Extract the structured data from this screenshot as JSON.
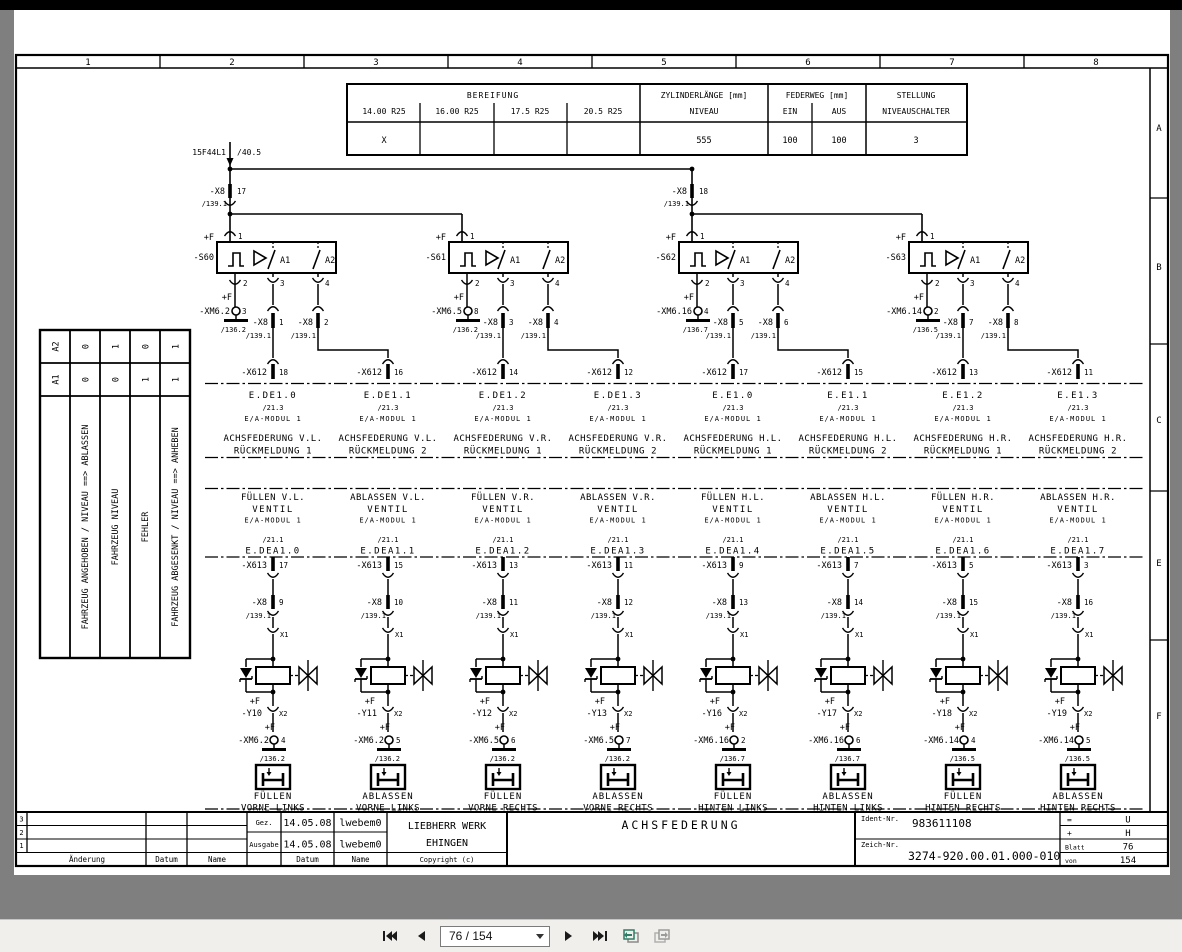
{
  "colors": {
    "paper": "#ffffff",
    "ink": "#000000",
    "viewer_bg": "#7f7f7f",
    "toolbar_bg": "#f1efeb",
    "view_icon_green": "#2e7d68",
    "view_icon_gray": "#9b9b9b"
  },
  "frame": {
    "column_labels": [
      "1",
      "2",
      "3",
      "4",
      "5",
      "6",
      "7",
      "8"
    ],
    "row_labels": [
      "A",
      "B",
      "C",
      "E",
      "F"
    ]
  },
  "spec_table": {
    "bereifung": "BEREIFUNG",
    "tires": [
      "14.00 R25",
      "16.00 R25",
      "17.5 R25",
      "20.5 R25"
    ],
    "tire_values": [
      "X",
      "",
      "",
      ""
    ],
    "zyl_l1": "ZYLINDERLÄNGE [mm]",
    "zyl_l2": "NIVEAU",
    "zyl_value": "555",
    "feder": "FEDERWEG [mm]",
    "feder_cols": [
      "EIN",
      "AUS"
    ],
    "feder_values": [
      "100",
      "100"
    ],
    "stellung_l1": "STELLUNG",
    "stellung_l2": "NIVEAUSCHALTER",
    "stellung_value": "3"
  },
  "state_table": {
    "header_col": [
      "A2",
      "A1"
    ],
    "columns": [
      {
        "a2": "0",
        "a1": "0",
        "label": "FAHRZEUG ANGEHOBEN / NIVEAU ==> ABLASSEN"
      },
      {
        "a2": "1",
        "a1": "0",
        "label": "FAHRZEUG NIVEAU"
      },
      {
        "a2": "0",
        "a1": "1",
        "label": "FEHLER"
      },
      {
        "a2": "1",
        "a1": "1",
        "label": "FAHRZEUG ABGESENKT / NIVEAU ==> ANHEBEN"
      }
    ]
  },
  "supply": {
    "label": "15F44L1",
    "ref": "/40.5"
  },
  "x8_top": [
    {
      "label": "-X8",
      "pin": "17",
      "ref": "/139.1"
    },
    {
      "label": "-X8",
      "pin": "18",
      "ref": "/139.1"
    }
  ],
  "sensors": [
    {
      "plus": "+F",
      "name": "-S60",
      "p1": "1",
      "p2": "2",
      "p3": "3",
      "p4": "4",
      "a1": "A1",
      "a2": "A2",
      "xm_plus": "+F",
      "xm": "-XM6.2",
      "xm_pin": "3",
      "xm_ref": "/136.2",
      "x8": "-X8",
      "x8_ref": "/139.1",
      "x8a_pin": "1",
      "x8b_pin": "2"
    },
    {
      "plus": "+F",
      "name": "-S61",
      "p1": "1",
      "p2": "2",
      "p3": "3",
      "p4": "4",
      "a1": "A1",
      "a2": "A2",
      "xm_plus": "+F",
      "xm": "-XM6.5",
      "xm_pin": "8",
      "xm_ref": "/136.2",
      "x8": "-X8",
      "x8_ref": "/139.1",
      "x8a_pin": "3",
      "x8b_pin": "4"
    },
    {
      "plus": "+F",
      "name": "-S62",
      "p1": "1",
      "p2": "2",
      "p3": "3",
      "p4": "4",
      "a1": "A1",
      "a2": "A2",
      "xm_plus": "+F",
      "xm": "-XM6.16",
      "xm_pin": "4",
      "xm_ref": "/136.7",
      "x8": "-X8",
      "x8_ref": "/139.1",
      "x8a_pin": "5",
      "x8b_pin": "6"
    },
    {
      "plus": "+F",
      "name": "-S63",
      "p1": "1",
      "p2": "2",
      "p3": "3",
      "p4": "4",
      "a1": "A1",
      "a2": "A2",
      "xm_plus": "+F",
      "xm": "-XM6.14",
      "xm_pin": "2",
      "xm_ref": "/136.5",
      "x8": "-X8",
      "x8_ref": "/139.1",
      "x8a_pin": "7",
      "x8b_pin": "8"
    }
  ],
  "feedback": [
    {
      "conn": "-X612",
      "pin": "18",
      "signal": "E.DE1.0",
      "ref": "/21.3",
      "module": "E/A-MODUL  1",
      "line1": "ACHSFEDERUNG V.L.",
      "line2": "RÜCKMELDUNG 1"
    },
    {
      "conn": "-X612",
      "pin": "16",
      "signal": "E.DE1.1",
      "ref": "/21.3",
      "module": "E/A-MODUL  1",
      "line1": "ACHSFEDERUNG V.L.",
      "line2": "RÜCKMELDUNG 2"
    },
    {
      "conn": "-X612",
      "pin": "14",
      "signal": "E.DE1.2",
      "ref": "/21.3",
      "module": "E/A-MODUL  1",
      "line1": "ACHSFEDERUNG V.R.",
      "line2": "RÜCKMELDUNG 1"
    },
    {
      "conn": "-X612",
      "pin": "12",
      "signal": "E.DE1.3",
      "ref": "/21.3",
      "module": "E/A-MODUL  1",
      "line1": "ACHSFEDERUNG V.R.",
      "line2": "RÜCKMELDUNG 2"
    },
    {
      "conn": "-X612",
      "pin": "17",
      "signal": "E.E1.0",
      "ref": "/21.3",
      "module": "E/A-MODUL  1",
      "line1": "ACHSFEDERUNG H.L.",
      "line2": "RÜCKMELDUNG 1"
    },
    {
      "conn": "-X612",
      "pin": "15",
      "signal": "E.E1.1",
      "ref": "/21.3",
      "module": "E/A-MODUL  1",
      "line1": "ACHSFEDERUNG H.L.",
      "line2": "RÜCKMELDUNG 2"
    },
    {
      "conn": "-X612",
      "pin": "13",
      "signal": "E.E1.2",
      "ref": "/21.3",
      "module": "E/A-MODUL  1",
      "line1": "ACHSFEDERUNG H.R.",
      "line2": "RÜCKMELDUNG 1"
    },
    {
      "conn": "-X612",
      "pin": "11",
      "signal": "E.E1.3",
      "ref": "/21.3",
      "module": "E/A-MODUL  1",
      "line1": "ACHSFEDERUNG H.R.",
      "line2": "RÜCKMELDUNG 2"
    }
  ],
  "valves": [
    {
      "func1": "FÜLLEN V.L.",
      "func2": "VENTIL",
      "module": "E/A-MODUL  1",
      "ref": "/21.1",
      "signal": "E.DEA1.0",
      "x613": "-X613",
      "x613_pin": "17",
      "x8": "-X8",
      "x8_pin": "9",
      "x8_ref": "/139.1",
      "x1": "X1",
      "x2": "X2",
      "y_plus": "+F",
      "y_name": "-Y10",
      "xm_plus": "+F",
      "xm": "-XM6.2",
      "xm_pin": "4",
      "xm_ref": "/136.2",
      "out1": "FÜLLEN",
      "out2": "VORNE LINKS"
    },
    {
      "func1": "ABLASSEN V.L.",
      "func2": "VENTIL",
      "module": "E/A-MODUL  1",
      "ref": "/21.1",
      "signal": "E.DEA1.1",
      "x613": "-X613",
      "x613_pin": "15",
      "x8": "-X8",
      "x8_pin": "10",
      "x8_ref": "/139.1",
      "x1": "X1",
      "x2": "X2",
      "y_plus": "+F",
      "y_name": "-Y11",
      "xm_plus": "+F",
      "xm": "-XM6.2",
      "xm_pin": "5",
      "xm_ref": "/136.2",
      "out1": "ABLASSEN",
      "out2": "VORNE LINKS"
    },
    {
      "func1": "FÜLLEN V.R.",
      "func2": "VENTIL",
      "module": "E/A-MODUL  1",
      "ref": "/21.1",
      "signal": "E.DEA1.2",
      "x613": "-X613",
      "x613_pin": "13",
      "x8": "-X8",
      "x8_pin": "11",
      "x8_ref": "/139.1",
      "x1": "X1",
      "x2": "X2",
      "y_plus": "+F",
      "y_name": "-Y12",
      "xm_plus": "+F",
      "xm": "-XM6.5",
      "xm_pin": "6",
      "xm_ref": "/136.2",
      "out1": "FÜLLEN",
      "out2": "VORNE RECHTS"
    },
    {
      "func1": "ABLASSEN V.R.",
      "func2": "VENTIL",
      "module": "E/A-MODUL  1",
      "ref": "/21.1",
      "signal": "E.DEA1.3",
      "x613": "-X613",
      "x613_pin": "11",
      "x8": "-X8",
      "x8_pin": "12",
      "x8_ref": "/139.1",
      "x1": "X1",
      "x2": "X2",
      "y_plus": "+F",
      "y_name": "-Y13",
      "xm_plus": "+F",
      "xm": "-XM6.5",
      "xm_pin": "7",
      "xm_ref": "/136.2",
      "out1": "ABLASSEN",
      "out2": "VORNE RECHTS"
    },
    {
      "func1": "FÜLLEN H.L.",
      "func2": "VENTIL",
      "module": "E/A-MODUL  1",
      "ref": "/21.1",
      "signal": "E.DEA1.4",
      "x613": "-X613",
      "x613_pin": "9",
      "x8": "-X8",
      "x8_pin": "13",
      "x8_ref": "/139.1",
      "x1": "X1",
      "x2": "X2",
      "y_plus": "+F",
      "y_name": "-Y16",
      "xm_plus": "+F",
      "xm": "-XM6.16",
      "xm_pin": "2",
      "xm_ref": "/136.7",
      "out1": "FÜLLEN",
      "out2": "HINTEN LINKS"
    },
    {
      "func1": "ABLASSEN H.L.",
      "func2": "VENTIL",
      "module": "E/A-MODUL  1",
      "ref": "/21.1",
      "signal": "E.DEA1.5",
      "x613": "-X613",
      "x613_pin": "7",
      "x8": "-X8",
      "x8_pin": "14",
      "x8_ref": "/139.1",
      "x1": "X1",
      "x2": "X2",
      "y_plus": "+F",
      "y_name": "-Y17",
      "xm_plus": "+F",
      "xm": "-XM6.16",
      "xm_pin": "6",
      "xm_ref": "/136.7",
      "out1": "ABLASSEN",
      "out2": "HINTEN LINKS"
    },
    {
      "func1": "FÜLLEN H.R.",
      "func2": "VENTIL",
      "module": "E/A-MODUL  1",
      "ref": "/21.1",
      "signal": "E.DEA1.6",
      "x613": "-X613",
      "x613_pin": "5",
      "x8": "-X8",
      "x8_pin": "15",
      "x8_ref": "/139.1",
      "x1": "X1",
      "x2": "X2",
      "y_plus": "+F",
      "y_name": "-Y18",
      "xm_plus": "+F",
      "xm": "-XM6.14",
      "xm_pin": "4",
      "xm_ref": "/136.5",
      "out1": "FÜLLEN",
      "out2": "HINTEN RECHTS"
    },
    {
      "func1": "ABLASSEN H.R.",
      "func2": "VENTIL",
      "module": "E/A-MODUL  1",
      "ref": "/21.1",
      "signal": "E.DEA1.7",
      "x613": "-X613",
      "x613_pin": "3",
      "x8": "-X8",
      "x8_pin": "16",
      "x8_ref": "/139.1",
      "x1": "X1",
      "x2": "X2",
      "y_plus": "+F",
      "y_name": "-Y19",
      "xm_plus": "+F",
      "xm": "-XM6.14",
      "xm_pin": "5",
      "xm_ref": "/136.5",
      "out1": "ABLASSEN",
      "out2": "HINTEN RECHTS"
    }
  ],
  "title_block": {
    "rev_rows": [
      "3",
      "2",
      "1"
    ],
    "aenderung": "Änderung",
    "datum1": "Datum",
    "name1": "Name",
    "gez_label": "Gez.",
    "gez_date": "14.05.08",
    "gez_name": "lwebem0",
    "ausgabe_label": "Ausgabe",
    "ausgabe_date": "14.05.08",
    "ausgabe_name": "lwebem0",
    "datum2": "Datum",
    "name2": "Name",
    "company1": "LIEBHERR WERK",
    "company2": "EHINGEN",
    "copyright": "Copyright (c)",
    "title": "ACHSFEDERUNG",
    "ident_label": "Ident-Nr.",
    "ident_value": "983611108",
    "zeich_label": "Zeich-Nr.",
    "zeich_value": "3274-920.00.01.000-010",
    "eq_label": "=",
    "eq_value": "U",
    "plus_label": "+",
    "plus_value": "H",
    "blatt_label": "Blatt",
    "blatt_value": "76",
    "von_label": "von",
    "von_value": "154"
  },
  "toolbar": {
    "page_value": "76 / 154",
    "buttons": [
      "first-page",
      "previous-page",
      "next-page",
      "last-page",
      "previous-view",
      "next-view"
    ]
  }
}
